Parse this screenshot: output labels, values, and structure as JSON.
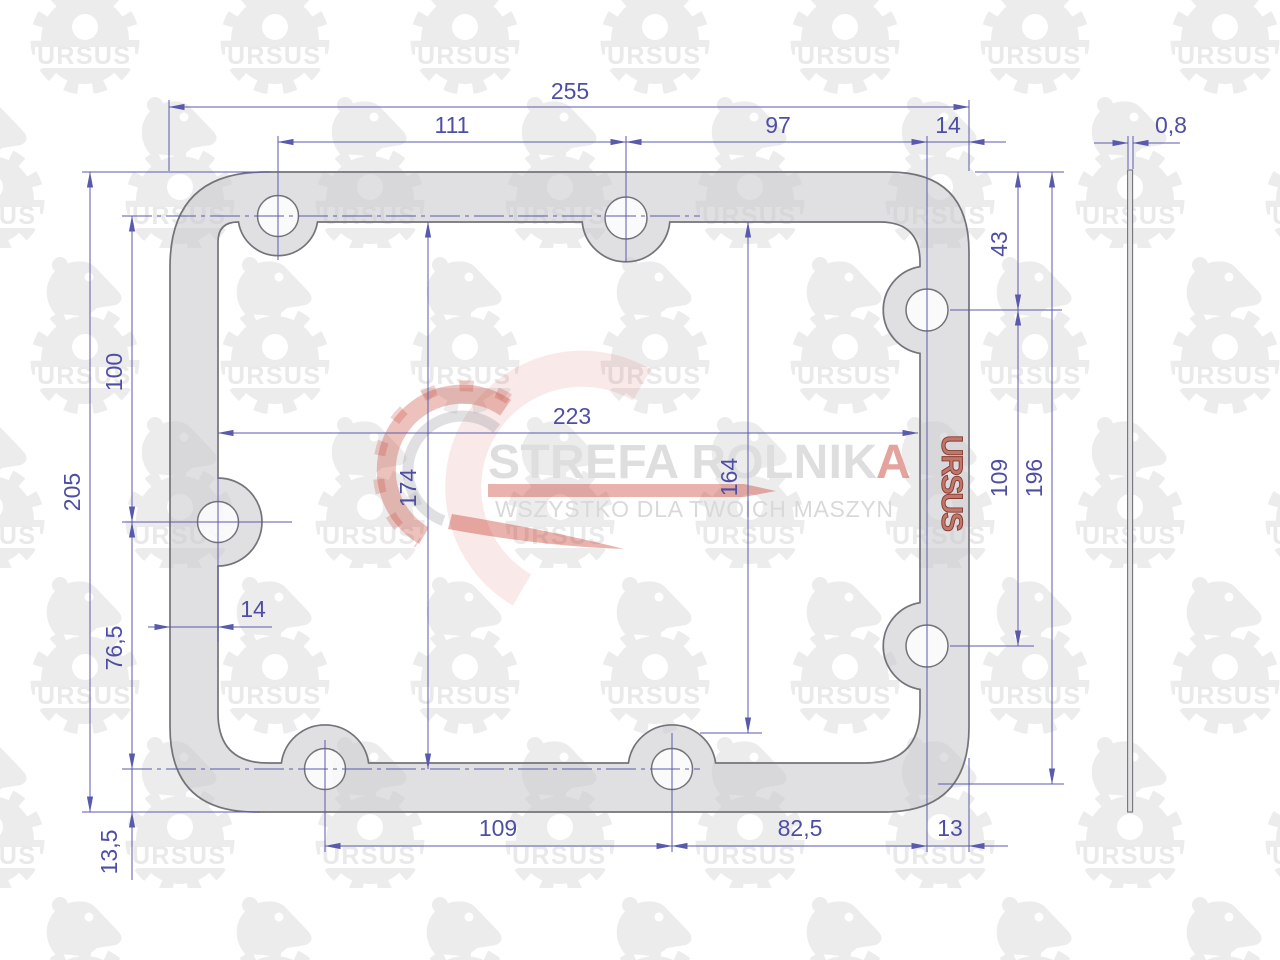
{
  "drawing": {
    "kind": "gasket technical drawing",
    "part_marking": "URSUS"
  },
  "dims": {
    "overall_width": "255",
    "top_left_span": "111",
    "top_right_span": "97",
    "top_right_edge": "14",
    "right_top_offset": "43",
    "overall_height": "205",
    "left_upper_span": "100",
    "inner_width": "223",
    "inner_height_left": "174",
    "inner_height_right": "164",
    "right_holes_span": "109",
    "right_height": "196",
    "left_lower_span": "76,5",
    "left_hole_offset": "14",
    "bottom_corner_offset": "13,5",
    "bottom_left_span": "109",
    "bottom_right_span": "82,5",
    "bottom_right_edge": "13",
    "thickness": "0,8"
  },
  "watermarks": {
    "tile_text": "URSUS",
    "logo_title_main": "STREFA ROLNIK",
    "logo_title_accent": "A",
    "logo_tagline": "WSZYSTKO DLA TWOICH MASZYN"
  },
  "colors": {
    "dimension_lines": "#5a5aad",
    "dimension_text": "#4e4ea5",
    "gasket_fill": "#e3e3e6",
    "gasket_stroke": "#73737a",
    "accent_red": "#c43426",
    "watermark_gray": "#ececec",
    "brand_mark_fill": "#c0776b",
    "brand_mark_outline": "#86382c"
  }
}
